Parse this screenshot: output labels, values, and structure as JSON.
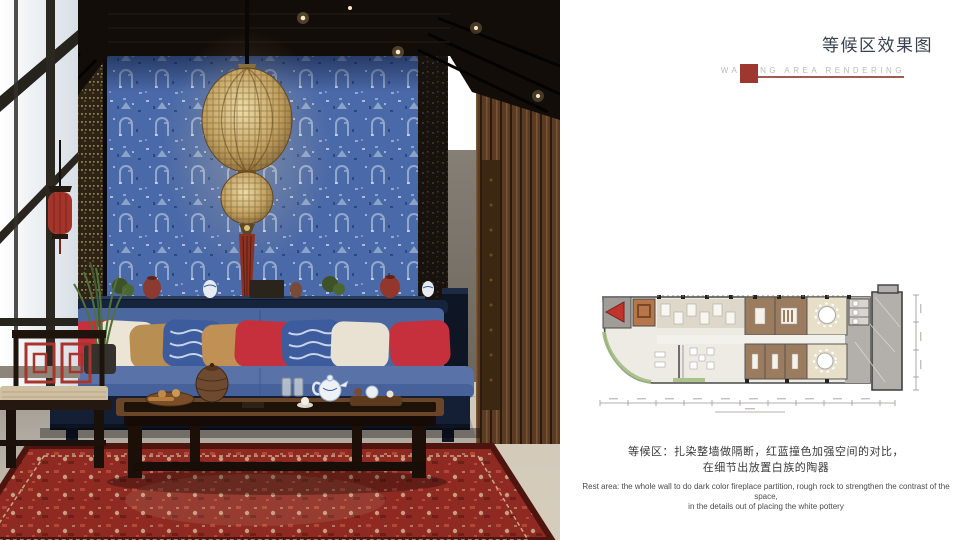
{
  "slide": {
    "title": "等候区效果图",
    "subtitle": "WAITING AREA RENDERING",
    "caption": {
      "zh_line1": "等候区：扎染整墙做隔断，红蓝撞色加强空间的对比，",
      "zh_line2": "在细节出放置白族的陶器",
      "en_line1": "Rest area: the whole wall to do dark color fireplace partition, rough rock to strengthen the contrast of the space,",
      "en_line2": "in the details out of placing the white pottery"
    },
    "colors": {
      "accent_red": "#9e372f",
      "title_text": "#39424f",
      "subtitle_text": "#bdbab8",
      "batik_wall_blue": "#4a69a8",
      "sofa_blue": "#5973a8",
      "rug_red": "#8e2a22",
      "plan_marker_red": "#c0342c"
    }
  }
}
